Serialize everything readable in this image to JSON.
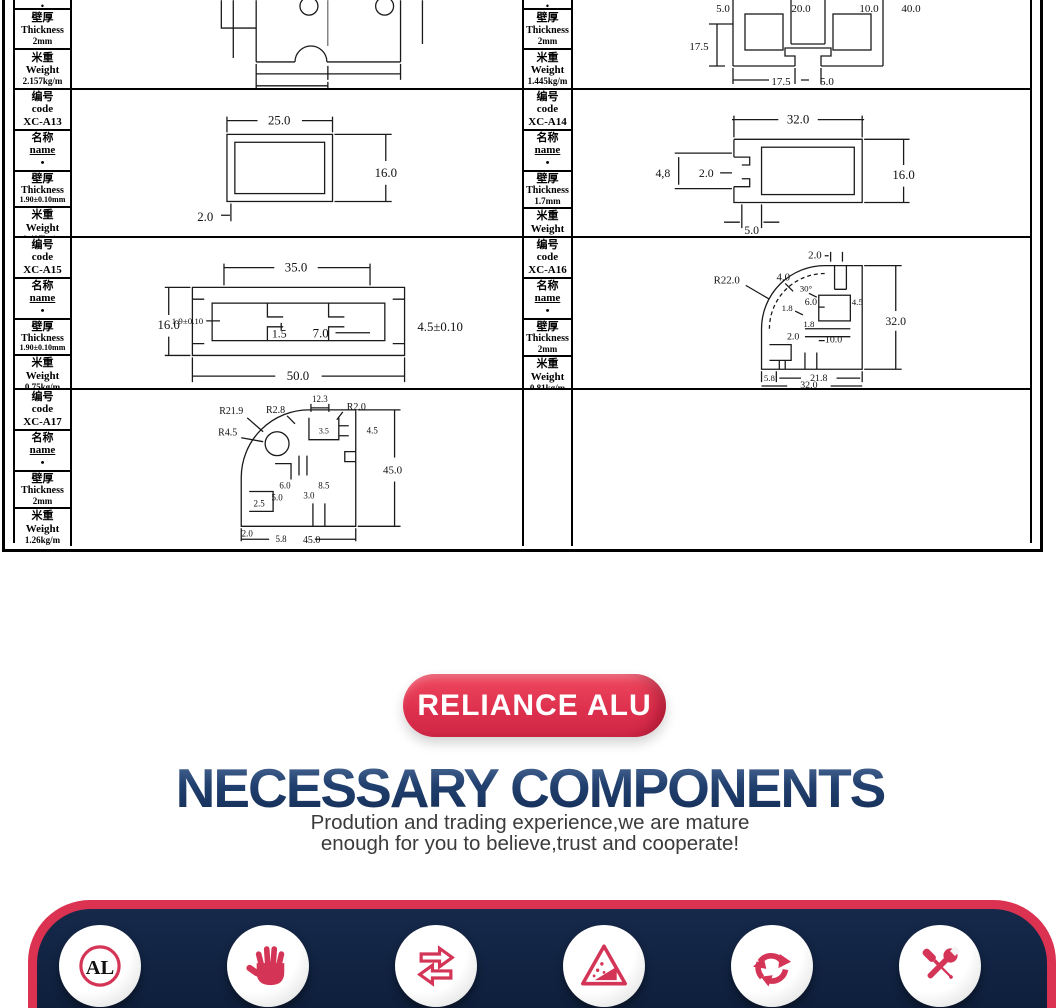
{
  "colors": {
    "accent_red": "#da3250",
    "icon_red": "#d43557",
    "band_navy": "#0e2038",
    "heading_blue": "#1e3a6b"
  },
  "spec_table": {
    "labels": {
      "code_cn": "编号",
      "code_en": "code",
      "name_cn": "名称",
      "name_en": "name",
      "name_dot": "•",
      "thickness_cn": "壁厚",
      "thickness_en": "Thickness",
      "weight_cn": "米重",
      "weight_en": "Weight"
    },
    "profiles": [
      {
        "thickness": "2mm",
        "weight": "2.157kg/m"
      },
      {
        "thickness": "2mm",
        "weight": "1.445kg/m"
      },
      {
        "code": "XC-A13",
        "thickness": "1.90±0.10mm",
        "weight": "0.407kg/m"
      },
      {
        "code": "XC-A14",
        "thickness": "1.7mm",
        "weight": "0.949kg/m"
      },
      {
        "code": "XC-A15",
        "thickness": "1.90±0.10mm",
        "weight": "0.75kg/m"
      },
      {
        "code": "XC-A16",
        "thickness": "2mm",
        "weight": "0.81kg/m"
      },
      {
        "code": "XC-A17",
        "thickness": "2mm",
        "weight": "1.26kg/m"
      }
    ],
    "drawings": {
      "r1r": {
        "d1": "5.0",
        "d2": "20.0",
        "d3": "10.0",
        "d4": "40.0",
        "d5": "17.5",
        "d6": "17.5",
        "d7": "5.0"
      },
      "d13": {
        "w": "25.0",
        "h": "16.0",
        "t": "2.0"
      },
      "d14": {
        "w": "32.0",
        "h": "16.0",
        "a": "4,8",
        "b": "2.0",
        "c": "5.0"
      },
      "d15": {
        "top": "35.0",
        "h": "16.0",
        "t": "1.9±0.10",
        "m1": "1.5",
        "m2": "7.0",
        "r": "4.5±0.10",
        "w": "50.0"
      },
      "d16": {
        "r": "R22.0",
        "a": "4.0",
        "ang": "30°",
        "top": "2.0",
        "i1": "1.8",
        "i2": "6.0",
        "i3": "4.5",
        "i4": "1.8",
        "i5": "2.0",
        "i6": "10.0",
        "h": "32.0",
        "b1": "5.8",
        "b2": "21.8",
        "w": "32.0"
      },
      "d17": {
        "r1": "R21.9",
        "r2": "R2.8",
        "t": "12.3",
        "r3": "R2.0",
        "r4": "R4.5",
        "i1": "3.5",
        "i2": "4.5",
        "i3": "6.0",
        "i4": "8.5",
        "i5": "3.0",
        "i6": "5.0",
        "h": "45.0",
        "b1": "2.5",
        "b2": "2.0",
        "b3": "5.8",
        "w": "45.0"
      }
    }
  },
  "branding": {
    "badge": "RELIANCE ALU",
    "heading": "NECESSARY COMPONENTS",
    "subtitle_line1": "Prodution and trading experience,we are mature",
    "subtitle_line2": "enough for you to believe,trust and cooperate!"
  },
  "footer": {
    "al_label": "AL"
  }
}
